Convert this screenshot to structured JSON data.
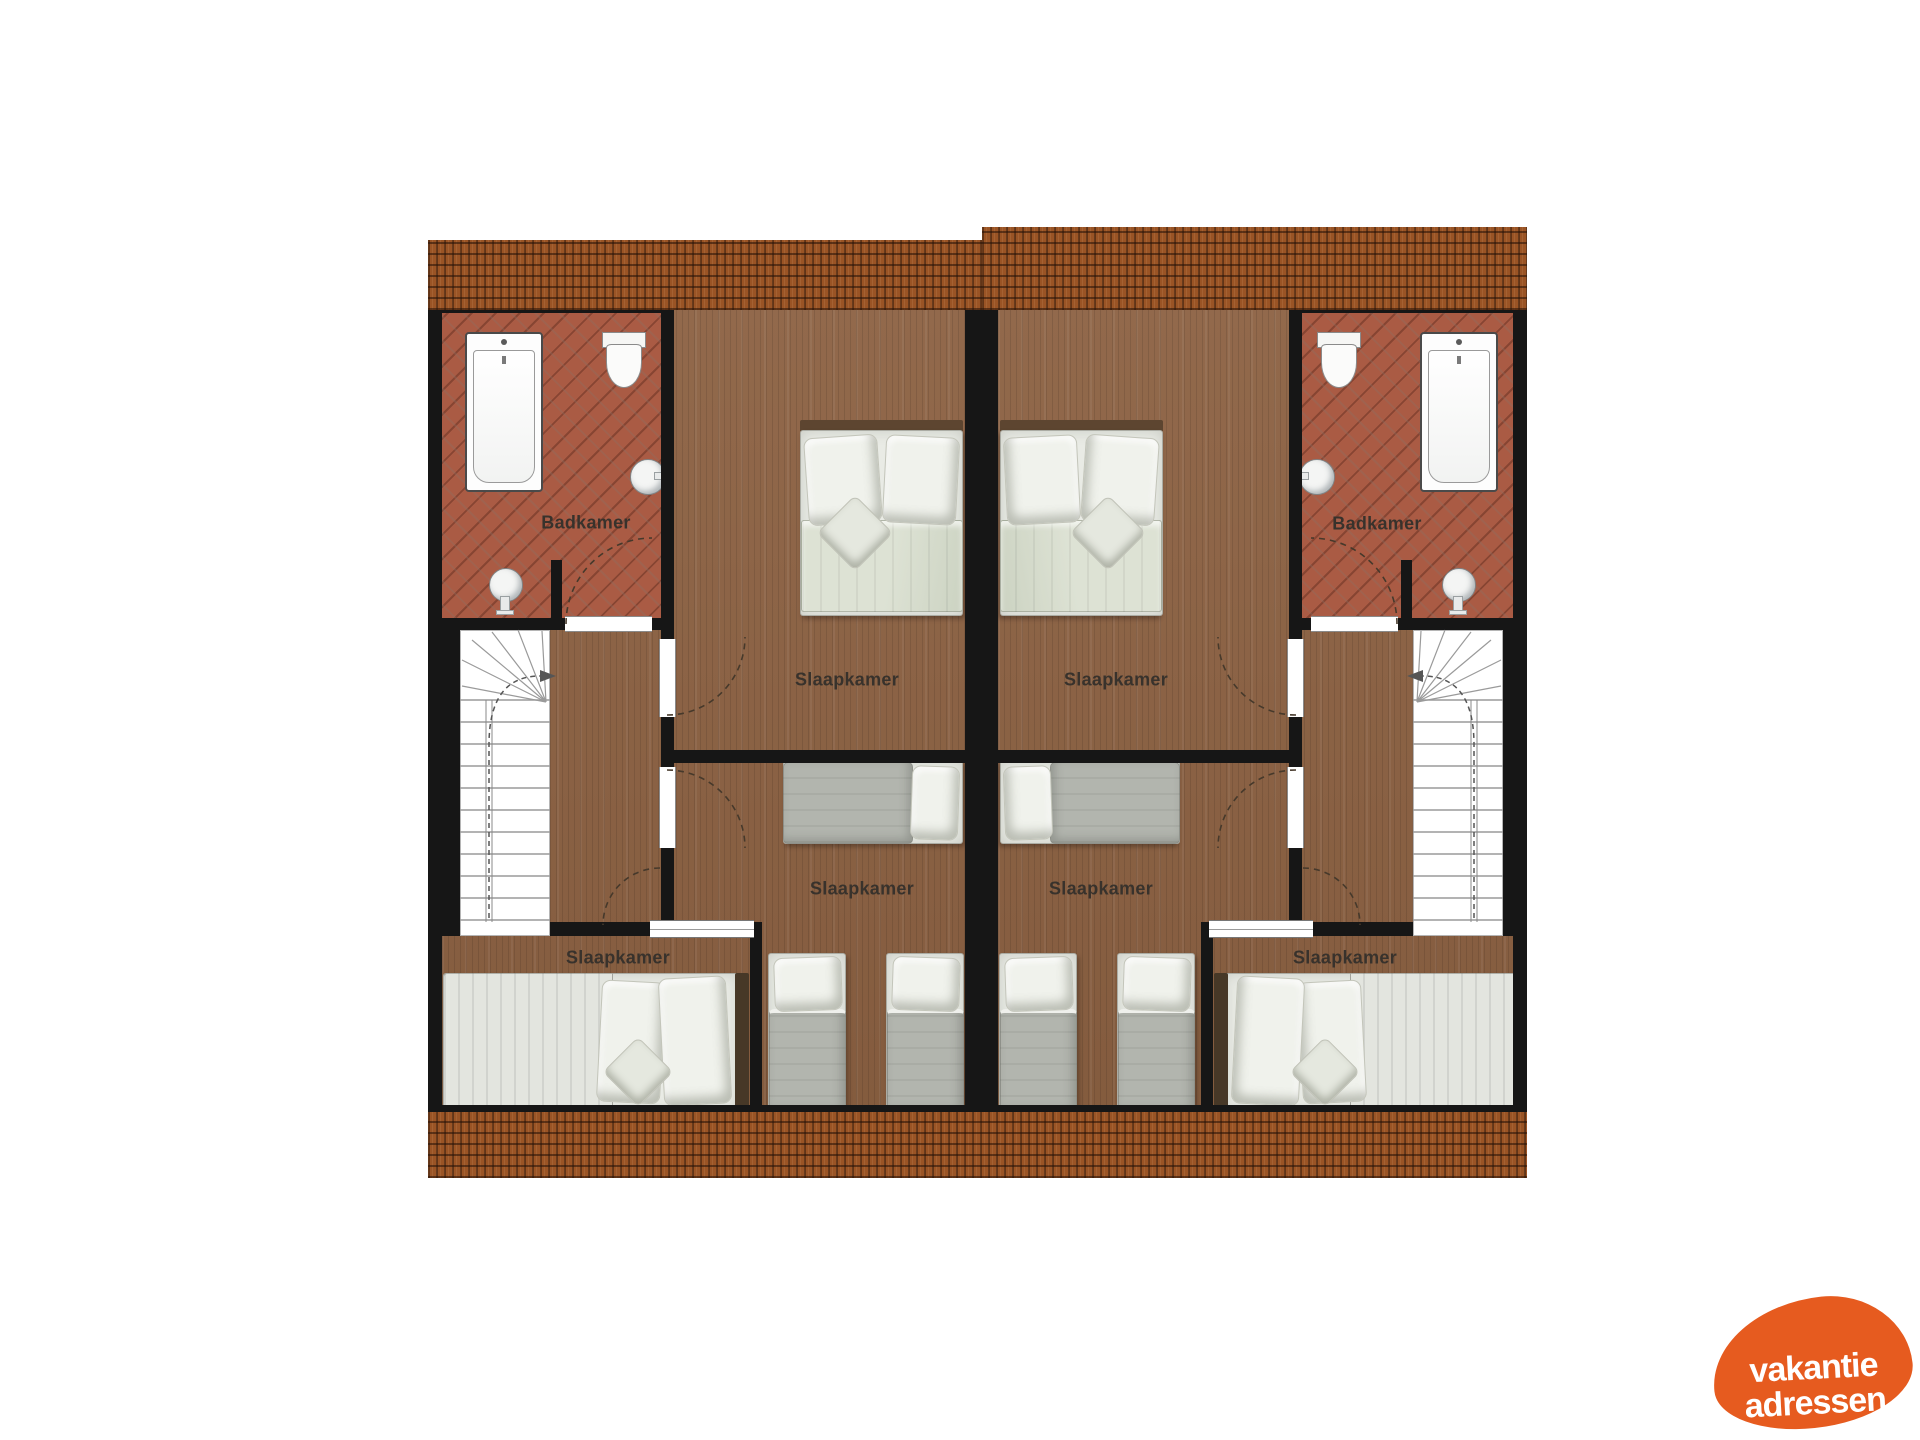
{
  "floorplan": {
    "room_labels": [
      {
        "id": "badkamer-left",
        "label": "Badkamer"
      },
      {
        "id": "slaapkamer-left-top",
        "label": "Slaapkamer"
      },
      {
        "id": "slaapkamer-left-middle",
        "label": "Slaapkamer"
      },
      {
        "id": "slaapkamer-left-bottom",
        "label": "Slaapkamer"
      },
      {
        "id": "badkamer-right",
        "label": "Badkamer"
      },
      {
        "id": "slaapkamer-right-top",
        "label": "Slaapkamer"
      },
      {
        "id": "slaapkamer-right-middle",
        "label": "Slaapkamer"
      },
      {
        "id": "slaapkamer-right-bottom",
        "label": "Slaapkamer"
      }
    ],
    "colors": {
      "wall": "#161616",
      "roof_tile": "#9a5425",
      "wood_floor": "#8c6142",
      "bathroom_tile": "#aa5b44",
      "bedding_white": "#e9ebe5",
      "bedding_grey": "#b2b5ae",
      "stairs": "#ffffff",
      "label_text": "#38322c"
    }
  },
  "logo": {
    "line1": "vakantie",
    "line2": "adressen",
    "background": "#e65b1f",
    "text_color": "#ffffff"
  }
}
